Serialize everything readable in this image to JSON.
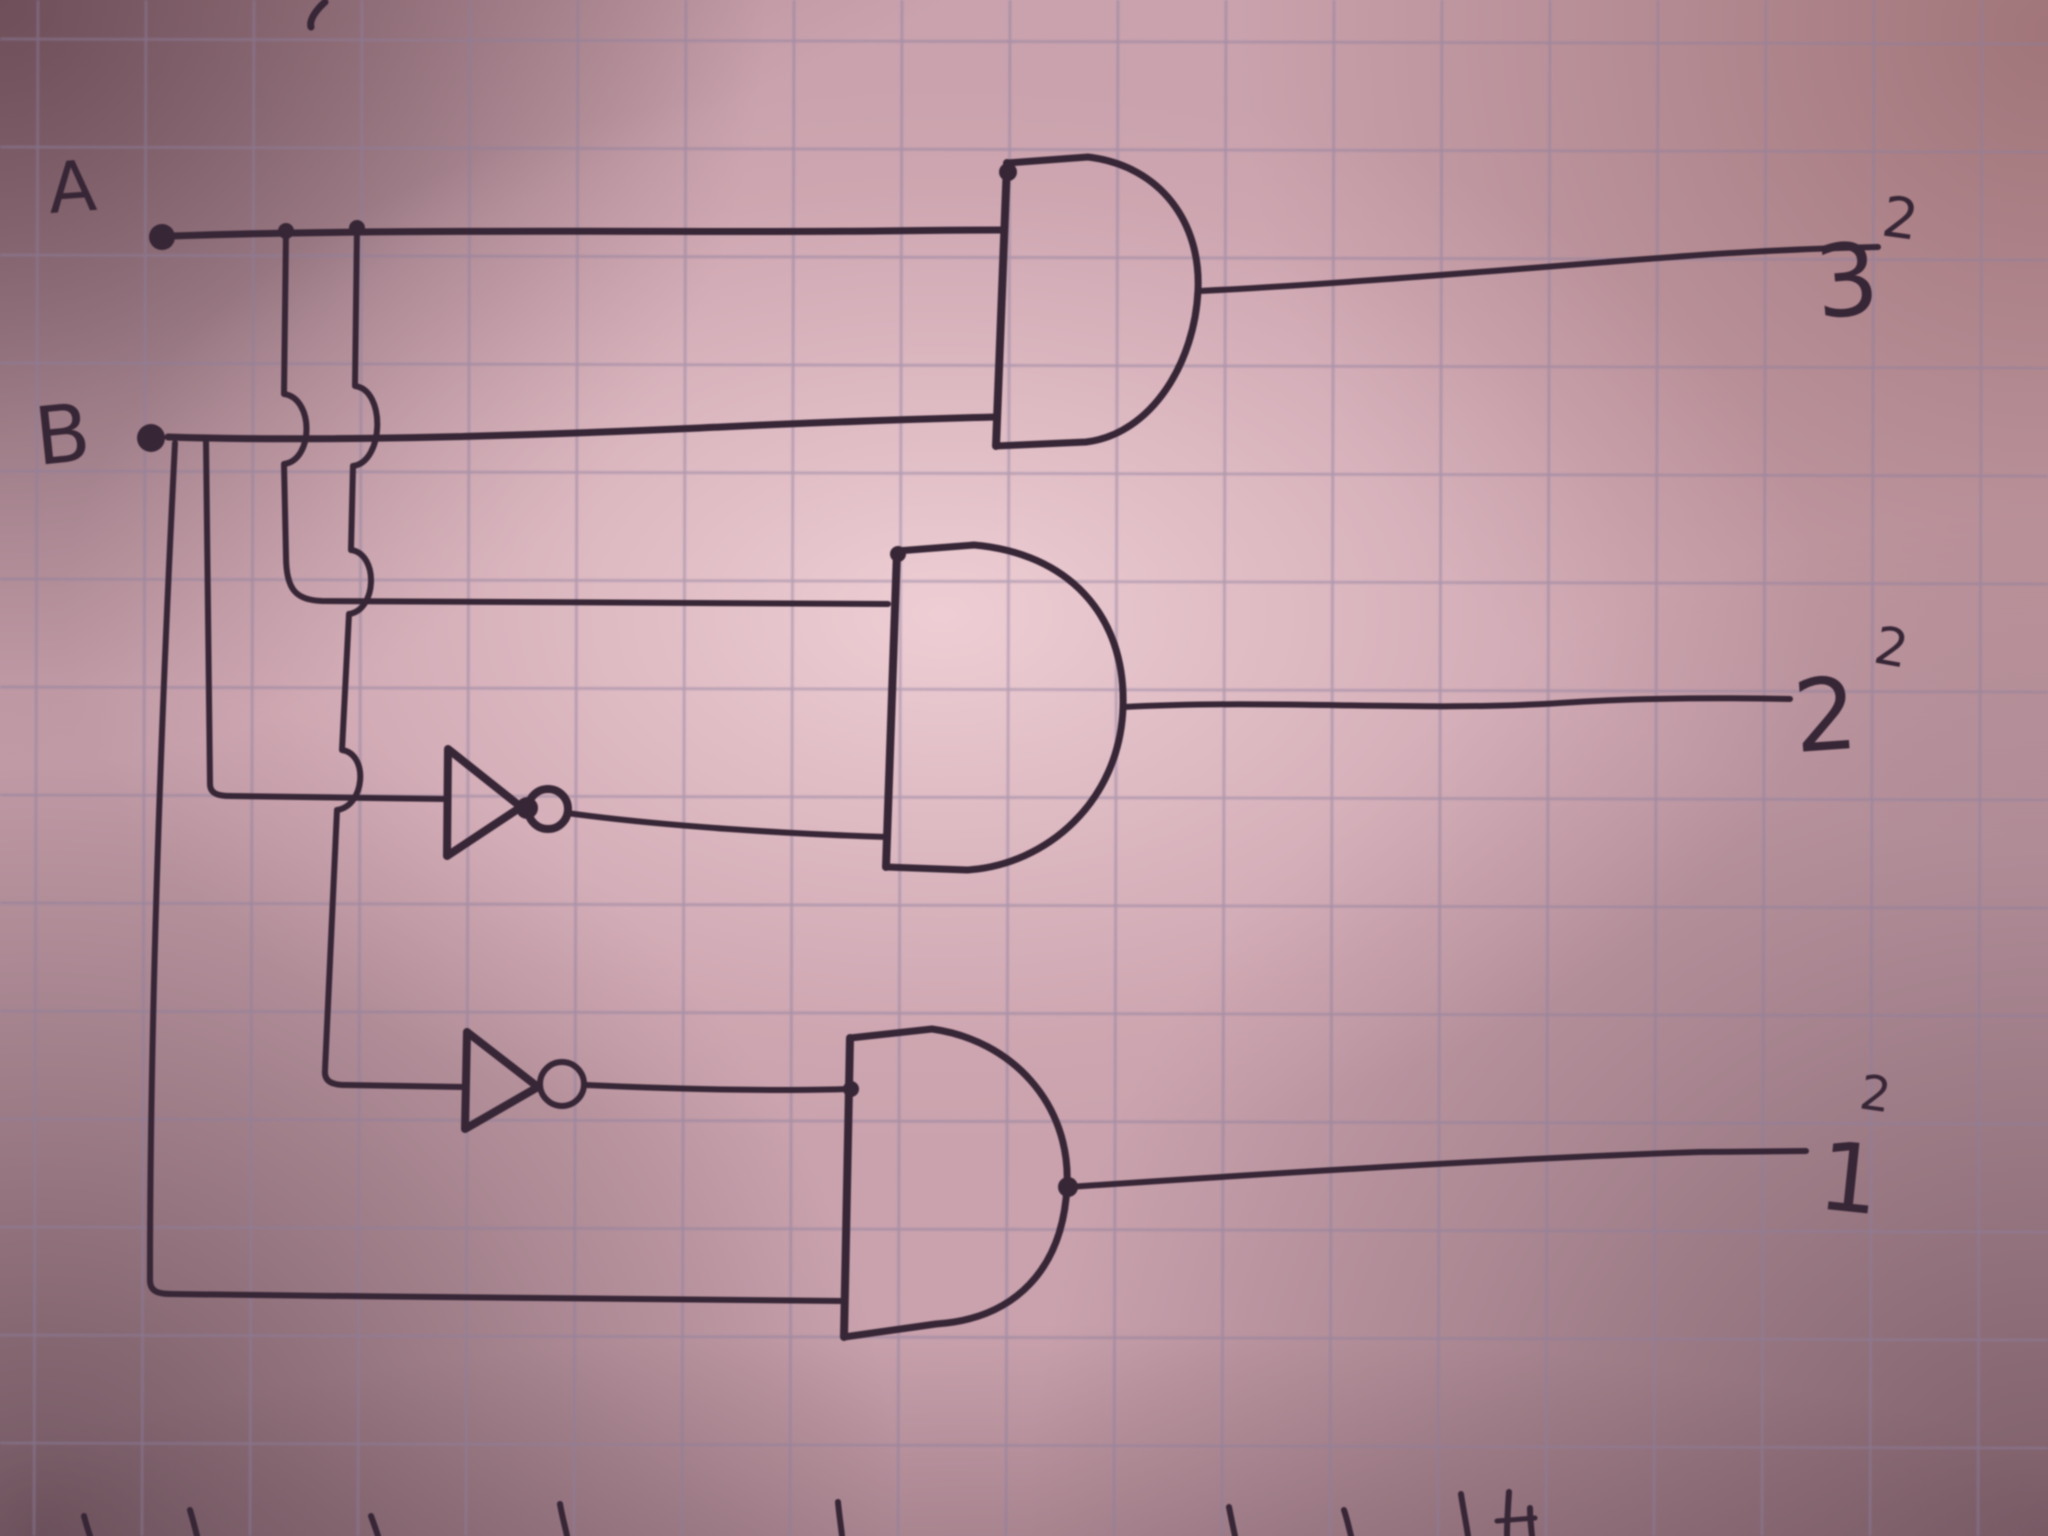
{
  "meta": {
    "description": "Hand-drawn digital logic schematic in dark ink on pink-tinted graph paper (photograph with vignette)",
    "paper_color": "#c9a2ad",
    "grid_color": "#8d7f9e",
    "ink_color": "#372636"
  },
  "circuit": {
    "inputs": [
      "A",
      "B"
    ],
    "outputs": [
      {
        "label": "3",
        "superscript": "2",
        "driven_by": "AND(A, B)"
      },
      {
        "label": "2",
        "superscript": "2",
        "driven_by": "AND(A, NOT B)"
      },
      {
        "label": "1",
        "superscript": "2",
        "driven_by": "AND(NOT A, B)"
      }
    ],
    "gates": [
      {
        "id": "and-top",
        "type": "AND",
        "inputs": [
          "A",
          "B"
        ],
        "output_label": "3"
      },
      {
        "id": "and-middle",
        "type": "AND",
        "inputs": [
          "A",
          "NOT B"
        ],
        "output_label": "2"
      },
      {
        "id": "and-bottom",
        "type": "AND",
        "inputs": [
          "NOT A",
          "B"
        ],
        "output_label": "1"
      },
      {
        "id": "not-b",
        "type": "NOT",
        "input": "B",
        "feeds": "and-middle"
      },
      {
        "id": "not-a",
        "type": "NOT",
        "input": "A",
        "feeds": "and-bottom"
      }
    ],
    "wire_crossings": "vertical taps hop over horizontal wires with semicircular bumps"
  },
  "drawing": {
    "wires": [
      {
        "name": "input-a-wire",
        "w": 7,
        "d": "M172,236 C400,228 700,233 880,231 C940,230 980,230 1004,230"
      },
      {
        "name": "input-b-wire",
        "w": 7,
        "d": "M168,437 C320,442 520,436 700,428 C800,423 920,419 995,417"
      },
      {
        "name": "a-tap-1-wire",
        "w": 6,
        "d": "M286,231 L284,394 C314,398 314,460 284,464 L286,556 C286,590 296,600 322,601 L888,604"
      },
      {
        "name": "a-tap-2-wire",
        "w": 6,
        "d": "M357,227 L355,386 C386,390 384,462 353,466 L351,550 C379,554 377,610 349,614 L342,750 C369,754 365,806 337,810 L325,1070 C324,1081 331,1085 346,1085 L463,1087"
      },
      {
        "name": "b-tap-1-wire",
        "w": 6,
        "d": "M175,443 C162,700 150,1000 150,1280 C150,1291 157,1294 172,1294 C400,1297 650,1299 843,1301"
      },
      {
        "name": "b-tap-2-wire",
        "w": 6,
        "d": "M206,441 L210,784 C210,793 217,796 230,796 L446,799"
      },
      {
        "name": "not-b-gate-triangle",
        "w": 8,
        "d": "M448,749 L447,856 L521,807 Z"
      },
      {
        "name": "not-b-output-wire",
        "w": 6,
        "d": "M567,813 C660,826 790,834 887,837"
      },
      {
        "name": "not-a-gate-triangle",
        "w": 8,
        "d": "M467,1032 L465,1129 L538,1087 Z"
      },
      {
        "name": "not-a-output-wire",
        "w": 6,
        "d": "M586,1085 C690,1090 790,1091 848,1089"
      },
      {
        "name": "and-top-gate-back",
        "w": 8,
        "d": "M1007,163 L996,446"
      },
      {
        "name": "and-top-gate-body",
        "w": 7,
        "d": "M1007,163 L1088,157 C1162,166 1201,224 1198,290 C1195,362 1152,434 1086,442 L996,446"
      },
      {
        "name": "and-top-output-wire",
        "w": 6,
        "d": "M1200,291 C1360,283 1560,265 1700,255 C1760,251 1830,248 1878,247"
      },
      {
        "name": "and-middle-gate-back",
        "w": 8,
        "d": "M897,551 L886,867"
      },
      {
        "name": "and-middle-gate-body",
        "w": 7,
        "d": "M897,551 L974,545 C1067,553 1126,614 1123,707 C1120,801 1047,865 967,870 L886,867"
      },
      {
        "name": "and-middle-output-wire",
        "w": 6,
        "d": "M1124,707 C1280,699 1420,712 1560,703 C1650,697 1740,698 1790,699"
      },
      {
        "name": "and-bottom-gate-back",
        "w": 8,
        "d": "M850,1038 L844,1337"
      },
      {
        "name": "and-bottom-gate-body",
        "w": 7,
        "d": "M850,1038 L932,1029 C1012,1040 1071,1104 1067,1186 C1063,1270 1014,1319 936,1324 L844,1337"
      },
      {
        "name": "and-bottom-output-wire",
        "w": 6,
        "d": "M1069,1187 C1260,1174 1520,1158 1700,1152 L1806,1151"
      },
      {
        "name": "stray-pen-mark-top",
        "w": 7,
        "d": "M325,2 C316,10 309,20 311,27"
      },
      {
        "name": "cutoff-writing-mark-1",
        "w": 6,
        "d": "M84,1516 C86,1524 88,1530 90,1536"
      },
      {
        "name": "cutoff-writing-mark-2",
        "w": 6,
        "d": "M190,1510 C193,1520 195,1528 197,1536"
      },
      {
        "name": "cutoff-writing-mark-3",
        "w": 6,
        "d": "M371,1516 C374,1524 376,1530 378,1536"
      },
      {
        "name": "cutoff-writing-mark-4",
        "w": 6,
        "d": "M560,1504 C562,1516 565,1526 567,1536"
      },
      {
        "name": "cutoff-writing-mark-5",
        "w": 6,
        "d": "M838,1502 C839,1514 841,1526 842,1536"
      },
      {
        "name": "cutoff-writing-mark-6",
        "w": 6,
        "d": "M1229,1507 C1231,1517 1233,1527 1235,1536"
      },
      {
        "name": "cutoff-writing-mark-7",
        "w": 6,
        "d": "M1344,1510 C1347,1519 1349,1528 1351,1536"
      },
      {
        "name": "cutoff-writing-mark-8",
        "w": 6,
        "d": "M1461,1494 C1463,1508 1466,1522 1468,1536"
      },
      {
        "name": "cutoff-writing-mark-9",
        "w": 6,
        "d": "M1509,1492 C1508,1506 1507,1521 1507,1536"
      },
      {
        "name": "cutoff-writing-mark-10",
        "w": 6,
        "d": "M1530,1508 C1530,1518 1531,1527 1532,1536"
      },
      {
        "name": "cutoff-writing-mark-11",
        "w": 5,
        "d": "M1497,1521 L1535,1518"
      }
    ],
    "dots": [
      {
        "name": "input-a-terminal-dot",
        "cx": 162,
        "cy": 237,
        "r": 13
      },
      {
        "name": "input-b-terminal-dot",
        "cx": 151,
        "cy": 438,
        "r": 14
      },
      {
        "name": "a-line-junction-dot-1",
        "cx": 286,
        "cy": 231,
        "r": 8
      },
      {
        "name": "a-line-junction-dot-2",
        "cx": 357,
        "cy": 228,
        "r": 8
      },
      {
        "name": "not-b-tip-ink-blob",
        "cx": 527,
        "cy": 808,
        "r": 11
      },
      {
        "name": "and-top-corner-ink-blob",
        "cx": 1008,
        "cy": 172,
        "r": 9
      },
      {
        "name": "and-middle-corner-ink-blob",
        "cx": 898,
        "cy": 554,
        "r": 8
      },
      {
        "name": "not-a-junction-ink-blob",
        "cx": 851,
        "cy": 1089,
        "r": 8
      },
      {
        "name": "and-bottom-output-blob",
        "cx": 1068,
        "cy": 1187,
        "r": 10
      }
    ],
    "bubbles": [
      {
        "name": "not-b-inversion-bubble",
        "cx": 548,
        "cy": 809,
        "r": 20,
        "w": 8
      },
      {
        "name": "not-a-inversion-bubble",
        "cx": 562,
        "cy": 1084,
        "r": 22,
        "w": 6
      }
    ],
    "labels": [
      {
        "name": "input-a-label",
        "text": "A",
        "x": 50,
        "y": 213,
        "size": 70,
        "rotate": -4
      },
      {
        "name": "input-b-label",
        "text": "B",
        "x": 38,
        "y": 465,
        "size": 80,
        "rotate": -6
      },
      {
        "name": "output-3-label",
        "text": "3",
        "x": 1818,
        "y": 318,
        "size": 100,
        "rotate": -5
      },
      {
        "name": "output-3-superscript-label",
        "text": "2",
        "x": 1880,
        "y": 235,
        "size": 56,
        "rotate": 8
      },
      {
        "name": "output-2-label",
        "text": "2",
        "x": 1796,
        "y": 752,
        "size": 100,
        "rotate": -4
      },
      {
        "name": "output-2-superscript-label",
        "text": "2",
        "x": 1872,
        "y": 662,
        "size": 52,
        "rotate": 10
      },
      {
        "name": "output-1-label",
        "text": "1",
        "x": 1816,
        "y": 1208,
        "size": 95,
        "rotate": 6
      },
      {
        "name": "output-1-superscript-label",
        "text": "2",
        "x": 1858,
        "y": 1108,
        "size": 48,
        "rotate": 8
      }
    ],
    "grid": {
      "start_x": 38,
      "start_y": 39,
      "step": 108
    }
  }
}
